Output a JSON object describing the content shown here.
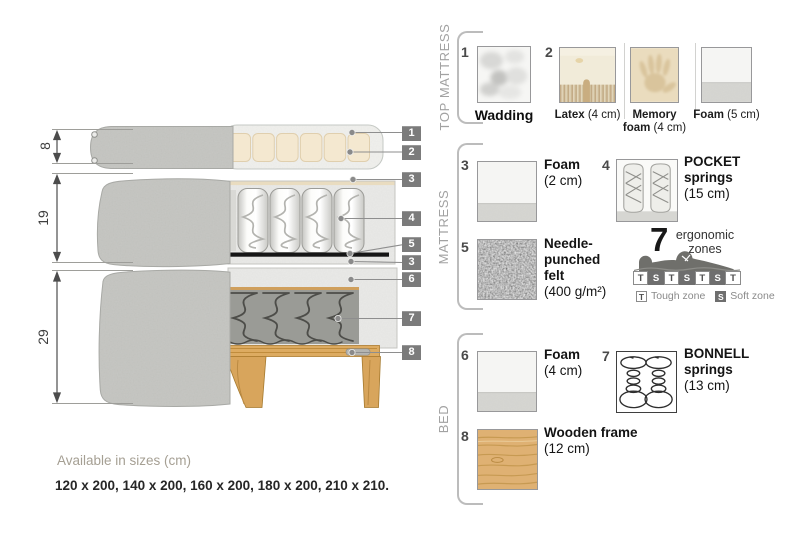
{
  "colors": {
    "label_bg": "#7b7b7b",
    "fabric_gray": "#c7c8c4",
    "foam_speckle": "#eaeae8",
    "latex_beige": "#f3e7cf",
    "wood": "#dfb173",
    "bonnell_gray": "#9a9b96",
    "zone_soft_bg": "#6e6e6e",
    "section_title_gray": "#a2a2a2"
  },
  "diagram": {
    "dims": [
      {
        "value": "8"
      },
      {
        "value": "19"
      },
      {
        "value": "29"
      }
    ],
    "callouts": [
      {
        "n": "1"
      },
      {
        "n": "2"
      },
      {
        "n": "3"
      },
      {
        "n": "4"
      },
      {
        "n": "5"
      },
      {
        "n": "3"
      },
      {
        "n": "6"
      },
      {
        "n": "7"
      },
      {
        "n": "8"
      }
    ],
    "sizes_title": "Available in sizes (cm)",
    "sizes_list": "120 x 200, 140 x 200, 160 x 200, 180 x 200, 210 x 210."
  },
  "panel": {
    "sections": [
      {
        "title": "TOP MATTRESS",
        "item1": {
          "num": "1",
          "name": "Wadding"
        },
        "item2": {
          "num": "2",
          "options": [
            {
              "name": "Latex",
              "detail": "(4 cm)"
            },
            {
              "name": "Memory foam",
              "detail": "(4 cm)"
            },
            {
              "name": "Foam",
              "detail": "(5 cm)"
            }
          ]
        }
      },
      {
        "title": "MATTRESS",
        "items": [
          {
            "num": "3",
            "name": "Foam",
            "detail": "(2 cm)"
          },
          {
            "num": "4",
            "name": "POCKET springs",
            "detail": "(15 cm)"
          },
          {
            "num": "5",
            "name": "Needle-punched felt",
            "detail": "(400 g/m²)"
          }
        ],
        "ergonomic": {
          "count": "7",
          "label1": "ergonomic",
          "label2": "zones",
          "zones": [
            "T",
            "S",
            "T",
            "S",
            "T",
            "S",
            "T"
          ],
          "legend": [
            {
              "symbol": "T",
              "label": "Tough zone"
            },
            {
              "symbol": "S",
              "label": "Soft zone"
            }
          ]
        }
      },
      {
        "title": "BED",
        "items": [
          {
            "num": "6",
            "name": "Foam",
            "detail": "(4 cm)"
          },
          {
            "num": "7",
            "name": "BONNELL springs",
            "detail": "(13 cm)"
          },
          {
            "num": "8",
            "name": "Wooden frame",
            "detail": "(12 cm)"
          }
        ]
      }
    ]
  }
}
